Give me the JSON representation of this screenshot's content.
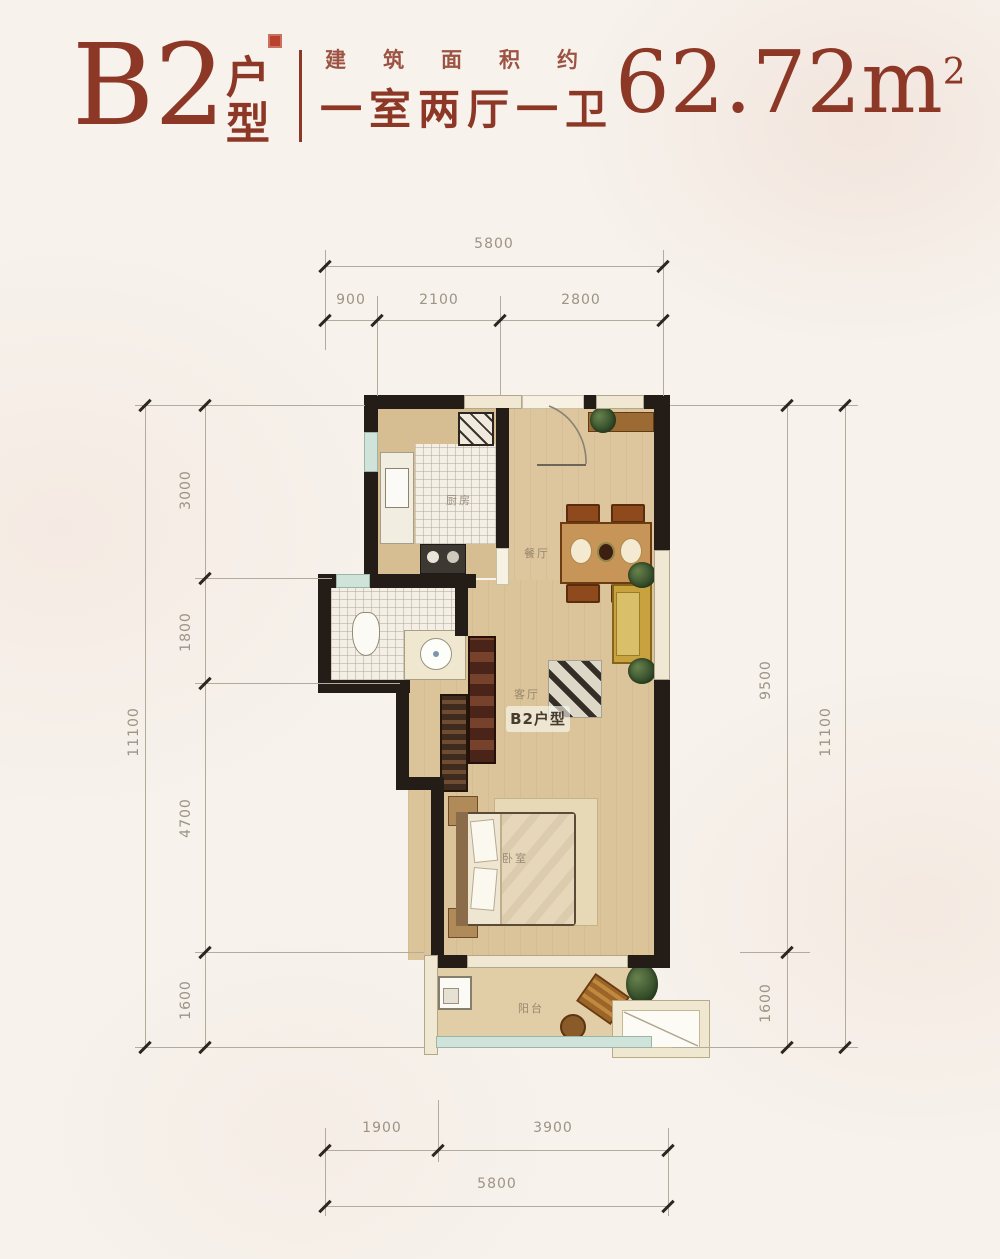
{
  "header": {
    "unit_code": "B2",
    "unit_type_label": "户型",
    "area_prefix": "建筑面积约",
    "room_layout": "一室两厅一卫",
    "area_number": "62.72",
    "area_unit": "m",
    "area_exponent": "2",
    "accent_color": "#8d3826"
  },
  "floorplan": {
    "watermark": "B2户型",
    "room_labels": {
      "kitchen": "厨房",
      "dining": "餐厅",
      "living": "客厅",
      "bedroom": "卧室",
      "balcony": "阳台"
    }
  },
  "dimensions": {
    "top": {
      "outer": "5800",
      "inner": [
        "900",
        "2100",
        "2800"
      ]
    },
    "bottom": {
      "outer": "5800",
      "inner": [
        "1900",
        "3900"
      ]
    },
    "left": {
      "outer": "11100",
      "inner": [
        "3000",
        "1800",
        "4700",
        "1600"
      ]
    },
    "right": {
      "outer": "11100",
      "inner": [
        "9500",
        "1600"
      ]
    }
  }
}
